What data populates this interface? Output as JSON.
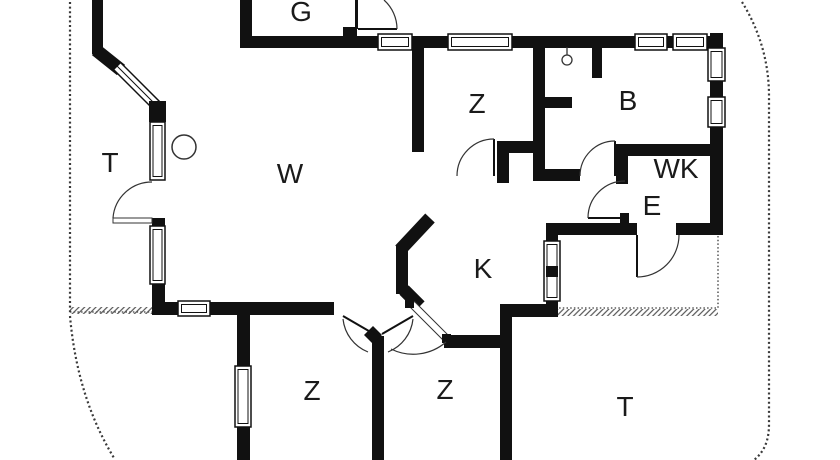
{
  "floorplan": {
    "type": "house-floor-plan",
    "wall_color": "#111111",
    "label_color": "#1a1a1a",
    "boundary_color": "#3a3a3a",
    "rooms": [
      {
        "id": "garage-top",
        "label": "G"
      },
      {
        "id": "terrace-left",
        "label": "T"
      },
      {
        "id": "living-room",
        "label": "W"
      },
      {
        "id": "bedroom-top",
        "label": "Z"
      },
      {
        "id": "bathroom",
        "label": "B"
      },
      {
        "id": "toilet-wk",
        "label": "WK"
      },
      {
        "id": "entry-e",
        "label": "E"
      },
      {
        "id": "kitchen",
        "label": "K"
      },
      {
        "id": "bedroom-bottom-left",
        "label": "Z"
      },
      {
        "id": "bedroom-bottom-right",
        "label": "Z"
      },
      {
        "id": "terrace-bottom-right",
        "label": "T"
      }
    ],
    "symbols": [
      {
        "id": "round-table-symbol",
        "shape": "circle"
      },
      {
        "id": "ceiling-lamp-symbol",
        "shape": "circle-with-stem"
      }
    ]
  }
}
